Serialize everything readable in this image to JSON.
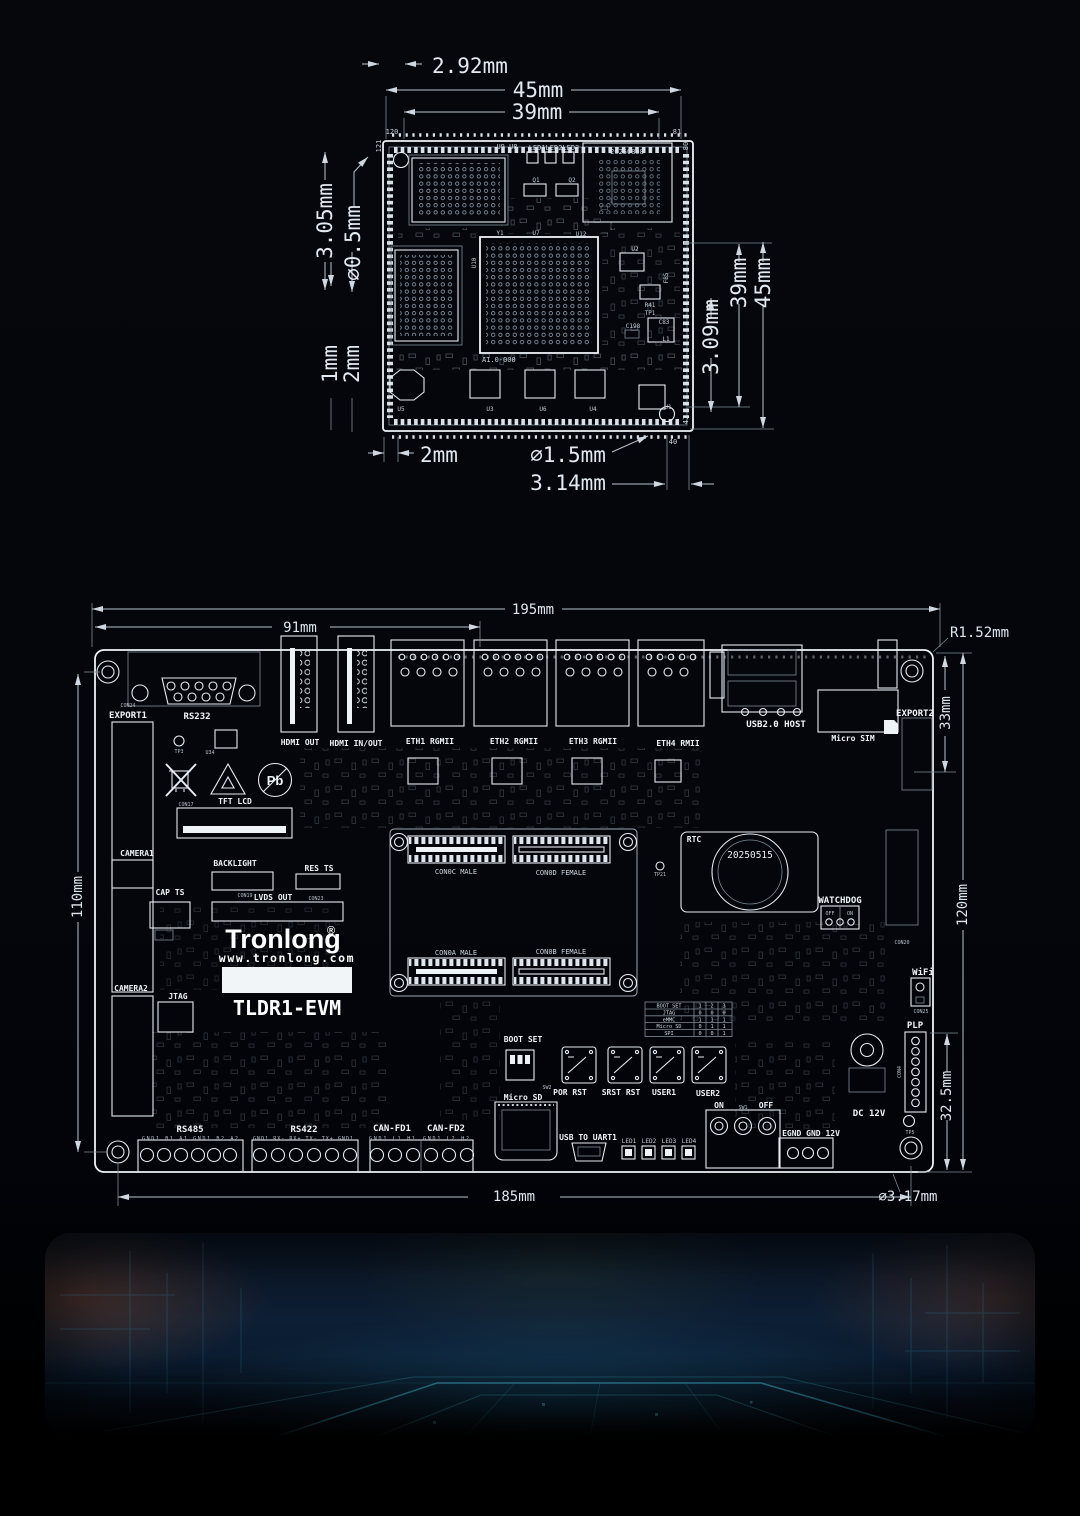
{
  "module": {
    "dims": {
      "top_offset": "2.92mm",
      "width_outer": "45mm",
      "width_inner": "39mm",
      "left_pitch": "3.05mm",
      "hole_small": "⌀0.5mm",
      "left_1mm": "1mm",
      "left_2mm": "2mm",
      "right_pitch": "3.09mm",
      "height_inner": "39mm",
      "height_outer": "45mm",
      "bottom_2mm": "2mm",
      "hole_mid": "⌀1.5mm",
      "bottom_offset": "3.14mm"
    },
    "silk": {
      "u9u8": "U9 U8",
      "leds": "LED1LED2LED3",
      "date_code": "20250808",
      "q1": "Q1",
      "q2": "Q2",
      "y1": "Y1",
      "u7": "U7",
      "u12": "U12",
      "u10": "U10",
      "soc": "A1.0-000",
      "u2": "U2",
      "fb5": "FB5",
      "r41": "R41",
      "tp1": "TP1",
      "c198": "C198",
      "c83": "C83",
      "l1": "L1",
      "u5": "U5",
      "u3": "U3",
      "u6": "U6",
      "u4": "U4",
      "u1": "U1"
    },
    "pins": {
      "p120": "120",
      "p121": "121",
      "p81": "81",
      "p80": "80",
      "p41": "41",
      "p40": "40"
    }
  },
  "board": {
    "dims": {
      "width_total": "195mm",
      "width_left": "91mm",
      "corner_radius": "R1.52mm",
      "height_top": "33mm",
      "height_left": "110mm",
      "height_right": "120mm",
      "height_bottom_right": "32.5mm",
      "width_holes": "185mm",
      "hole_dia": "⌀3.17mm"
    },
    "connectors": {
      "export1": "EXPORT1",
      "con24": "CON24",
      "rs232": "RS232",
      "hdmi_out": "HDMI OUT",
      "hdmi_inout": "HDMI IN/OUT",
      "eth1": "ETH1 RGMII",
      "eth2": "ETH2 RGMII",
      "eth3": "ETH3 RGMII",
      "eth4": "ETH4 RMII",
      "usb_host": "USB2.0 HOST",
      "micro_sim": "Micro SIM",
      "export2": "EXPORT2",
      "camera1": "CAMERA1",
      "camera2": "CAMERA2",
      "jtag": "JTAG",
      "tft_lcd": "TFT LCD",
      "backlight": "BACKLIGHT",
      "res_ts": "RES TS",
      "cap_ts": "CAP TS",
      "lvds_out": "LVDS OUT",
      "con17": "CON17",
      "con19": "CON19",
      "con23": "CON23",
      "con0c": "CON0C MALE",
      "con0d": "CON0D FEMALE",
      "con0a": "CON0A MALE",
      "con0b": "CON0B FEMALE",
      "rs485": "RS485",
      "rs422": "RS422",
      "canfd1": "CAN-FD1",
      "canfd2": "CAN-FD2",
      "rs485_pins": "GND1 B1 A1 GND1 B2 A2",
      "rs422_pins": "GND1 RX- RX+ TX- TX+ GND1",
      "canfd1_pins": "GND1 L1 H1",
      "canfd2_pins": "GND1 L2 H2",
      "micro_sd": "Micro SD",
      "usb_uart": "USB TO UART1",
      "dc12v": "DC 12V",
      "egnd": "EGND GND 12V",
      "plp": "PLP",
      "wifi": "WiFi",
      "con20": "CON20",
      "con25": "CON25",
      "con4": "CON4"
    },
    "controls": {
      "boot_set": "BOOT SET",
      "sw2": "SW2",
      "por_rst": "POR RST",
      "srst_rst": "SRST RST",
      "user1": "USER1",
      "user2": "USER2",
      "led1": "LED1",
      "led2": "LED2",
      "led3": "LED3",
      "led4": "LED4",
      "on": "ON",
      "sw1": "SW1",
      "off": "OFF",
      "watchdog": "WATCHDOG",
      "wd_off": "OFF",
      "wd_on": "ON",
      "rtc": "RTC",
      "battery_date": "20250515"
    },
    "refs": {
      "tp3": "TP3",
      "u34": "U34",
      "tp5": "TP5",
      "tp21": "TP21"
    },
    "icons": {
      "pb": "Pb"
    },
    "brand": {
      "name": "Tronlong",
      "reg": "®",
      "site": "www.tronlong.com",
      "model": "TLDR1-EVM"
    },
    "boot_table": {
      "header": [
        "BOOT SET",
        "1",
        "2",
        "3"
      ],
      "rows": [
        [
          "JTAG",
          "0",
          "0",
          "0"
        ],
        [
          "eMMC",
          "1",
          "1",
          "1"
        ],
        [
          "Micro SD",
          "0",
          "1",
          "1"
        ],
        [
          "SPI",
          "0",
          "0",
          "1"
        ]
      ]
    }
  }
}
